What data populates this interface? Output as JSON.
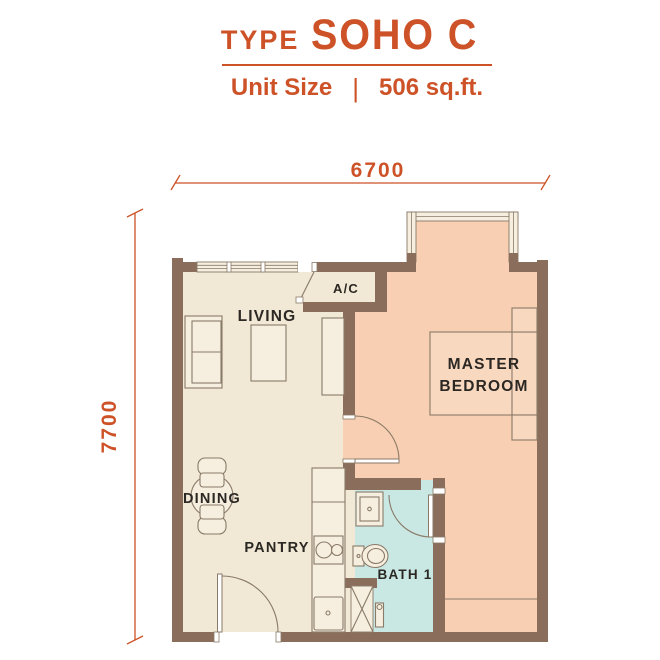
{
  "header": {
    "type_label": "TYPE",
    "type_value": "SOHO C",
    "unit_size_label": "Unit Size",
    "separator": "|",
    "unit_size_value": "506 sq.ft."
  },
  "dimensions": {
    "width": "6700",
    "height": "7700"
  },
  "rooms": {
    "living": "LIVING",
    "ac": "A/C",
    "master_line1": "MASTER",
    "master_line2": "BEDROOM",
    "dining": "DINING",
    "pantry": "PANTRY",
    "bath": "BATH 1"
  },
  "colors": {
    "accent_orange": "#cd5227",
    "wall_brown": "#8a6d5b",
    "floor_cream": "#f1e8d5",
    "floor_peach": "#f8cfb2",
    "floor_teal": "#c9e8e4",
    "counter_cream": "#f6efdf",
    "line_brown": "#8a7a68",
    "label_dark": "#2b2723"
  }
}
